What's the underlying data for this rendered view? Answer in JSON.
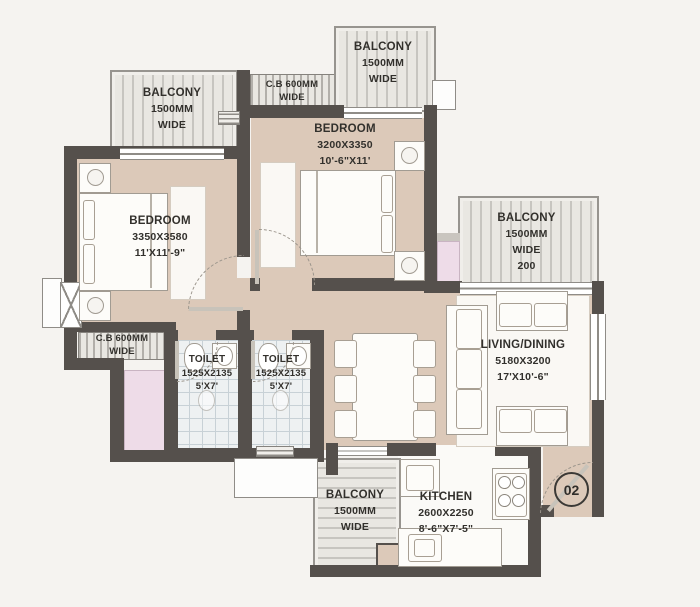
{
  "unit": {
    "number": "02"
  },
  "labels": {
    "balcony_top_left": {
      "lines": [
        "BALCONY",
        "1500MM",
        "WIDE"
      ]
    },
    "cb_top": {
      "lines": [
        "C.B 600MM",
        "WIDE"
      ]
    },
    "balcony_top": {
      "lines": [
        "BALCONY",
        "1500MM",
        "WIDE"
      ]
    },
    "bedroom_top": {
      "lines": [
        "BEDROOM",
        "3200X3350",
        "10'-6\"X11'"
      ]
    },
    "bedroom_left": {
      "lines": [
        "BEDROOM",
        "3350X3580",
        "11'X11'-9\""
      ]
    },
    "balcony_right": {
      "lines": [
        "BALCONY",
        "1500MM",
        "WIDE",
        "200"
      ]
    },
    "living_dining": {
      "lines": [
        "LIVING/DINING",
        "5180X3200",
        "17'X10'-6\""
      ]
    },
    "cb_left": {
      "lines": [
        "C.B 600MM",
        "WIDE"
      ]
    },
    "toilet_left": {
      "lines": [
        "TOILET",
        "1525X2135",
        "5'X7'"
      ]
    },
    "toilet_right": {
      "lines": [
        "TOILET",
        "1525X2135",
        "5'X7'"
      ]
    },
    "balcony_bottom": {
      "lines": [
        "BALCONY",
        "1500MM",
        "WIDE"
      ]
    },
    "kitchen": {
      "lines": [
        "KITCHEN",
        "2600X2250",
        "8'-6\"X7'-5\""
      ]
    }
  },
  "colors": {
    "wall": "#55504c",
    "floor_beige": "#dcc9b9",
    "toilet_tile": "#eef1f2",
    "shaft_pink": "#eedce8",
    "balcony_grey": "#e7e5e2",
    "paper": "#f5f3f0"
  }
}
